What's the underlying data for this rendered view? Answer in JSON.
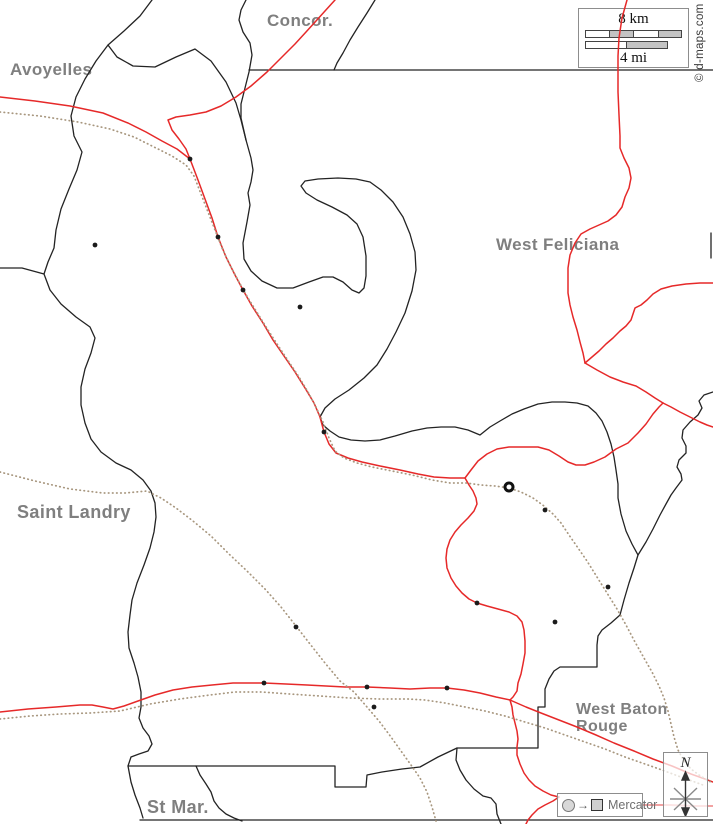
{
  "canvas": {
    "width": 713,
    "height": 824,
    "background": "#ffffff"
  },
  "colors": {
    "boundary": "#232323",
    "road": "#e62929",
    "road_light": "#f2a2a2",
    "railway": "#a8977f",
    "label": "#7f7f7f"
  },
  "copyright": {
    "text": "© d-maps.com"
  },
  "scale": {
    "km_label": "8 km",
    "mi_label": "4 mi"
  },
  "legend": {
    "arrow_glyph": "→",
    "projection": "Mercator"
  },
  "compass": {
    "north_label": "N"
  },
  "labels": {
    "avoyelles": {
      "text": "Avoyelles",
      "x": 10,
      "y": 61,
      "size": 17
    },
    "concordia": {
      "text": "Concor.",
      "x": 267,
      "y": 12,
      "size": 17
    },
    "west_feliciana": {
      "text": "West Feliciana",
      "x": 496,
      "y": 236,
      "size": 17
    },
    "saint_landry": {
      "text": "Saint Landry",
      "x": 17,
      "y": 503,
      "size": 18
    },
    "west_baton_rouge": {
      "text": "West Baton Rouge",
      "x": 576,
      "y": 702,
      "size": 16,
      "w": 120
    },
    "st_martin": {
      "text": "St Mar.",
      "x": 147,
      "y": 798,
      "size": 18
    }
  },
  "map": {
    "layers": [
      {
        "id": "boundary-top-left-wave",
        "cls": "boundary",
        "pts": "152,0 140,16 124,31 108,45 117,57 133,66 155,67 176,57 195,49 211,61 226,82 236,103 241,120 246,140"
      },
      {
        "id": "boundary-north-arc",
        "cls": "boundary",
        "pts": "246,0 241,10 239,20 243,32 250,43 252,55 249,72 245,88 241,104 241,118 246,140"
      },
      {
        "id": "boundary-center-river-oxbow",
        "cls": "boundary",
        "pts": "246,140 251,158 253,170 251,182 248,193 250,205 247,222 243,243 244,259 251,271 262,281 277,288 293,288 309,282 323,277 333,277 343,282 352,290 359,293 364,288 366,276 366,256 363,237 357,224 347,215 332,207 317,200 306,193 301,186 305,181 318,179 338,178 356,179 370,182 381,190 393,202 403,217 410,234 415,252 416,270 412,291 405,313 396,332 387,349 377,365 364,378 349,390 335,399 325,408 320,417 323,425 330,431 339,437 351,440 365,441 380,440 395,436 412,431 427,428 441,427 455,427 468,430 480,435 490,427 500,421 512,414 524,409 538,404 552,402 565,402 577,403 588,406 596,413 602,421 607,432 611,444 614,457 616,470 618,484 618,498 621,514 626,531 632,544 638,555"
      },
      {
        "id": "boundary-east-meander",
        "cls": "boundary",
        "pts": "713,392 704,395 699,401 702,408 698,415 690,422 683,430 682,438 686,446 686,453 679,460 677,467 681,474 682,480 676,488 671,495 666,504 660,515 653,529 646,542 638,555 634,568 629,583 624,600 620,615 611,623 602,630 598,636 597,645 597,667 578,667 560,667 554,671 549,679 545,689 545,707 538,707 538,728 538,748 515,748 490,748 457,748 456,760 460,770 466,780 474,789 483,796 491,798 496,804 497,814 501,824"
      },
      {
        "id": "boundary-north-horizontal",
        "cls": "boundary",
        "pts": "249,70 713,70"
      },
      {
        "id": "boundary-right-edge-stub",
        "cls": "boundary",
        "pts": "711,233 711,258"
      },
      {
        "id": "boundary-north-diagonal",
        "cls": "boundary",
        "pts": "375,0 367,13 358,27 350,40 343,53 337,63 334,70"
      },
      {
        "id": "boundary-west-river",
        "cls": "boundary",
        "pts": "108,45 96,61 85,79 76,97 71,116 74,136 82,152 77,170 69,189 61,209 56,230 54,248 48,262 44,274 50,290 61,304 76,317 90,327 95,338 91,353 85,369 81,387 81,405 85,423 91,439 101,452 116,463 131,470 143,480 151,491 155,503 156,517 154,532 150,548 144,565 137,583 132,600 130,615 128,632 129,648 134,663 138,677 141,692 141,707 139,718 143,728 149,736 152,744 148,751 139,754 131,757 128,766 131,782 135,795 140,808 143,818"
      },
      {
        "id": "boundary-west-edge-stub",
        "cls": "boundary",
        "pts": "0,268 22,268 44,274"
      },
      {
        "id": "boundary-south-survey-line",
        "cls": "boundary",
        "pts": "128,766 200,766 270,766 335,766 335,787 366,787 367,775 382,772 402,769 420,767 438,757 457,748"
      },
      {
        "id": "boundary-stmartin-branch",
        "cls": "boundary",
        "pts": "196,766 200,775 206,784 211,792 214,801 219,808 226,814 234,818 242,821"
      },
      {
        "id": "boundary-bottom-horizontal",
        "cls": "boundary",
        "w": "2.2",
        "pts": "140,820 713,820"
      },
      {
        "id": "road-la1-north",
        "cls": "road",
        "pts": "335,0 325,11 316,21 306,32 295,44 282,57 267,72 251,86 236,97 221,106 206,112 190,115 176,117 168,120 172,130 179,139 186,149 190,159"
      },
      {
        "id": "road-west-avoyelles",
        "cls": "road",
        "pts": "0,97 35,101 70,106 103,113 128,123 146,132 162,141 177,149 190,159"
      },
      {
        "id": "road-la1-diagonal",
        "cls": "road",
        "pts": "190,159 198,180 205,199 212,218 218,237 226,257 235,275 243,290 252,306 263,323 273,340 284,356 295,372 305,388 314,403 320,417 324,432 329,444 336,453 348,458 362,462 380,466 400,470 418,474 434,477 450,478 465,478"
      },
      {
        "id": "road-la10-east",
        "cls": "road",
        "pts": "465,478 471,470 478,461 487,454 497,449 509,447 524,447 538,447 549,450 559,456 568,462 576,465 585,465 594,462 605,457 616,449 628,443 638,433 646,424 653,414 659,407 663,403"
      },
      {
        "id": "road-junction-to-right-edge",
        "cls": "road",
        "pts": "663,403 671,407 680,412 690,417 700,422 707,425 713,427"
      },
      {
        "id": "road-junction-link",
        "cls": "road",
        "pts": "585,363 597,370 610,377 623,382 636,386 646,392 655,398 663,403"
      },
      {
        "id": "road-river-north",
        "cls": "road",
        "pts": "627,0 622,18 619,38 618,56 618,70 618,92 619,115 620,136 620,148 624,158 629,168 631,178 629,188 625,197 622,207 616,215 608,221 599,225 590,229 581,234 575,243 570,255 568,268 568,281 568,293 570,305 573,317 577,330 580,342 583,353 585,363"
      },
      {
        "id": "road-east-feliciana",
        "cls": "road",
        "pts": "713,283 700,283 686,284 672,286 661,289 653,294 647,300 641,305 635,308 633,314 631,320 626,326 620,331 613,338 606,344 599,351 592,357 585,363"
      },
      {
        "id": "road-newroads-meander",
        "cls": "road",
        "pts": "465,478 469,485 473,491 476,498 477,504 474,511 468,518 461,525 455,532 450,540 447,549 446,558 447,568 451,578 456,586 462,593 469,599 477,603 487,606 498,609 509,612 517,616 522,622 524,630 525,641 525,653 523,664 521,674 518,683 517,691 513,697 510,700"
      },
      {
        "id": "road-us190-south",
        "cls": "road",
        "pts": "0,712 28,709 56,707 80,705 92,705 103,707 113,709 124,706 138,701 155,695 173,690 192,687 212,685 233,683 250,683 264,683 286,684 307,685 326,686 345,687 367,687 390,688 410,689 430,688 447,688 464,690 480,693 496,697 510,700 526,707 541,713 559,720 577,727 596,735 614,743 634,751 653,759 672,766 691,774 705,779 713,782"
      },
      {
        "id": "road-meander-south",
        "cls": "road",
        "pts": "510,700 512,707 513,715 515,723 517,731 518,739 517,747 517,755 520,764 524,773 529,780 535,786 543,791 551,795 559,797 553,801 545,805 538,809 532,815 528,820 526,824"
      },
      {
        "id": "road-southeast-light",
        "cls": "road-light",
        "pts": "643,805 670,805 695,806 713,806"
      },
      {
        "id": "railway-la1",
        "cls": "rail",
        "pts": "0,112 40,116 78,122 110,129 134,137 154,147 172,156 186,165 194,176 201,194 208,212 215,230 222,248 230,265 239,282 248,298 258,314 268,330 279,347 289,362 299,377 308,392 316,407 323,422 329,438 335,451 344,458 357,463 372,467 392,471 412,475 432,480 450,483 466,483 481,485 495,486 509,488 521,492 533,498 544,506 553,514 561,523 569,535 578,548 587,561 597,577 607,593 617,609 626,625 635,642 644,658 652,672 659,686 664,698 668,711 671,724 674,737 678,750 684,761 691,769 699,775 707,780 713,783"
      },
      {
        "id": "railway-landry-diagonal",
        "cls": "rail",
        "pts": "0,472 35,481 70,489 103,493 125,493 147,491 161,498 176,508 193,521 211,536 229,554 247,571 265,589 281,607 296,626 310,644 325,663 340,681 354,692 367,707 379,721 391,737 401,751 411,765 420,778 427,792 432,807 436,821"
      },
      {
        "id": "railway-us190",
        "cls": "rail",
        "pts": "0,719 30,716 60,714 90,713 120,711 150,704 180,699 210,695 235,692 262,692 290,694 320,696 350,698 380,699 408,699 425,700 445,703 465,707 485,711 505,716 525,722 545,728 565,735 585,742 605,749 625,757 645,764 662,770 678,776 692,781 703,785"
      }
    ],
    "towns": [
      [
        95,
        245
      ],
      [
        190,
        159
      ],
      [
        218,
        237
      ],
      [
        243,
        290
      ],
      [
        300,
        307
      ],
      [
        324,
        432
      ],
      [
        477,
        603
      ],
      [
        545,
        510
      ],
      [
        555,
        622
      ],
      [
        608,
        587
      ],
      [
        296,
        627
      ],
      [
        264,
        683
      ],
      [
        367,
        687
      ],
      [
        447,
        688
      ],
      [
        374,
        707
      ]
    ],
    "capital": {
      "x": 509,
      "y": 487,
      "r": 4
    }
  }
}
